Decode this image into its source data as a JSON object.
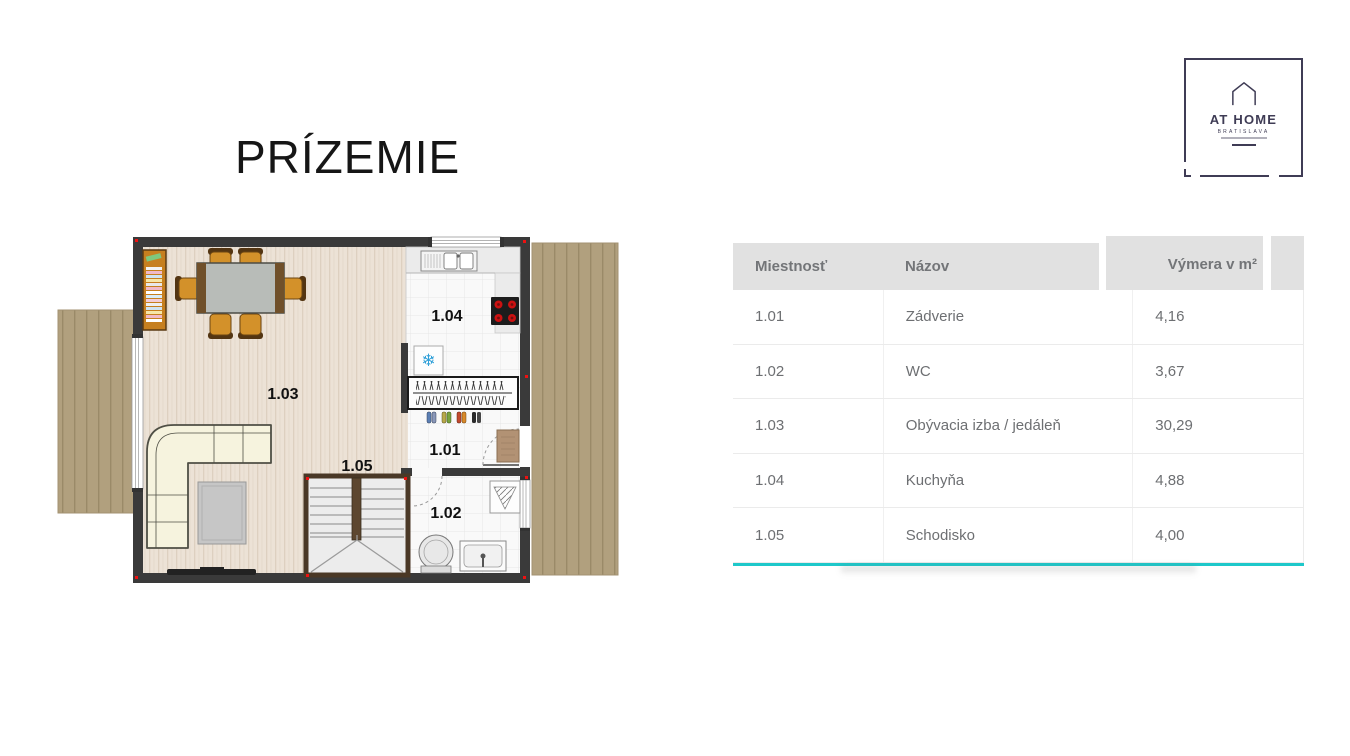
{
  "page": {
    "background": "#ffffff",
    "floor_title": "PRÍZEMIE"
  },
  "logo": {
    "name": "AT HOME",
    "subtitle": "BRATISLAVA",
    "brand_color": "#3f3c55"
  },
  "floorplan": {
    "room_labels": [
      "1.01",
      "1.02",
      "1.03",
      "1.04",
      "1.05"
    ],
    "snowflake_glyph": "❄",
    "colors": {
      "wall": "#3a3a3a",
      "wood_floor": "#ece2d6",
      "tile_floor": "#f9f9f9",
      "terrace_deck": "#b1a07e",
      "corner_marker": "#ee1111",
      "stair_frame": "#4a3826",
      "sofa": "#f6f3de",
      "chair_seat": "#d3912a",
      "stove_burner": "#cc1111",
      "freezer_snowflake": "#2f9fd8"
    }
  },
  "table": {
    "columns": [
      "Miestnosť",
      "Názov",
      "Výmera v m²"
    ],
    "rows": [
      {
        "id": "1.01",
        "name": "Zádverie",
        "area": "4,16"
      },
      {
        "id": "1.02",
        "name": "WC",
        "area": "3,67"
      },
      {
        "id": "1.03",
        "name": "Obývacia izba / jedáleň",
        "area": "30,29"
      },
      {
        "id": "1.04",
        "name": "Kuchyňa",
        "area": "4,88"
      },
      {
        "id": "1.05",
        "name": "Schodisko",
        "area": "4,00"
      }
    ],
    "accent_color": "#1ec8ca",
    "header_bg": "#e1e1e1",
    "text_color": "#6d6f72"
  }
}
